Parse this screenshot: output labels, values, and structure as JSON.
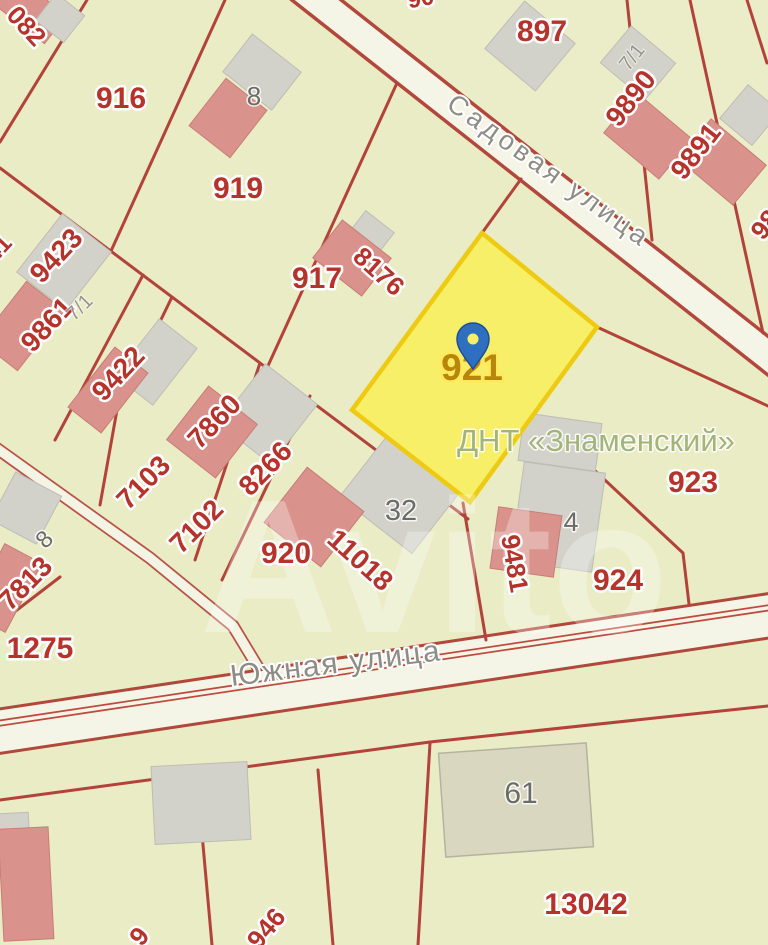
{
  "map": {
    "watermark": "Avito",
    "area_label": "ДНТ «Знаменский»",
    "selected_parcel": {
      "number": "921"
    },
    "streets": {
      "sadovaya": "Садовая улица",
      "yuzhnaya": "Южная улица"
    },
    "parcel_labels": {
      "l082": "082",
      "l41": "41",
      "l90": "90",
      "l916": "916",
      "l919": "919",
      "l897": "897",
      "l9890": "9890",
      "l9891": "9891",
      "l98": "98",
      "l9423": "9423",
      "l9861": "9861",
      "l917": "917",
      "l8176": "8176",
      "l9422": "9422",
      "l7860": "7860",
      "l7103": "7103",
      "l7102": "7102",
      "l8266": "8266",
      "l920": "920",
      "l11018": "11018",
      "l923": "923",
      "l9481": "9481",
      "l924": "924",
      "l7813": "7813",
      "l1275": "1275",
      "l13042": "13042",
      "l946": "946",
      "l9": "9"
    },
    "building_labels": {
      "b8": "8",
      "b71": "7/1",
      "b71b": "7/1",
      "b32": "32",
      "b4": "4",
      "b8b": "8",
      "b61": "61"
    },
    "colors": {
      "background": "#e9ecc4",
      "boundary_red": "#b2423a",
      "parcel_label_red": "#b5332b",
      "selected_fill": "#f8ef68",
      "selected_border": "#eecb12",
      "selected_label": "#b8860b",
      "pin_blue": "#2e6fc0",
      "street_label_gray": "#8d8d85",
      "area_label_green": "#a2b478",
      "building_pink": "#da928c",
      "building_gray": "#d2d2cb",
      "road_fill": "#f5f5e7"
    }
  }
}
